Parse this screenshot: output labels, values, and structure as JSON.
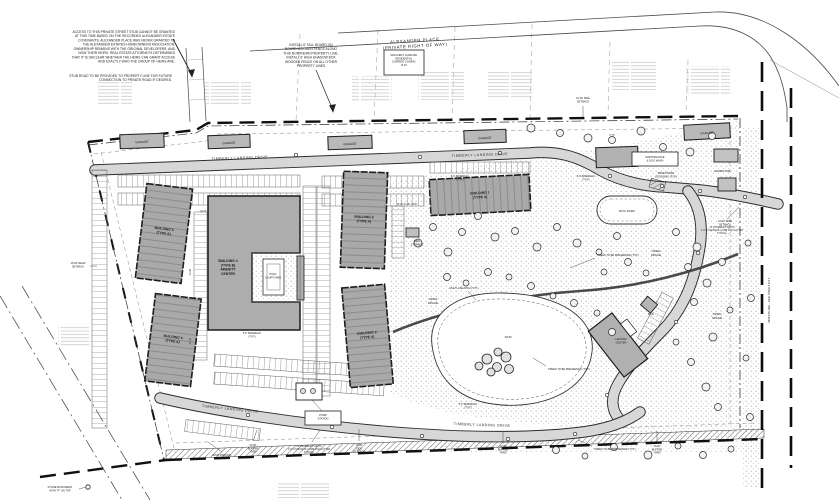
{
  "d": {
    "streets": {
      "alex": [
        "ALEXANDER PLACE",
        "(PRIVATE RIGHT OF WAY)"
      ],
      "timberly": "TIMBERLY LANDING DRIVE"
    },
    "notes": {
      "access": [
        "ACCESS TO THIS PRIVATE STREET STUB CANNOT BE GRANTED",
        "AT THIS TIME BASED ON THE RECORDED ALEXANDER ESTATE",
        "COVENANTS. ALEXANDER PLACE WAS NEVER GRANTED TO",
        "THE ALEXANDER ESTATES HOMEOWNERS ASSOCIATION.",
        "OWNERSHIP REMAINS WITH THE ORIGINAL DEVELOPERS, AND",
        "NOW THEIR HEIRS. REAL ESTATE ATTORNEYS DETERMINED",
        "THAT IT IS UNCLEAR WHETHER THE HEIRS CAN GRANT ACCESS",
        "AND EXACTLY WHO THE GROUP OF HEIRS ARE."
      ],
      "stub": [
        "STUB ROAD TO BE PROVIDED TO PROPERTY LINE FOR FUTURE",
        "CONNECTION TO PRIVATE ROAD IF DESIRED."
      ],
      "fence": [
        "INSTALL 6' TALL BOARD ON",
        "BOARD WOODEN FENCE ALONG",
        "THIS NORTHERN PROPERTY LINE.",
        "INSTALL 6' HIGH SHADOW BOX",
        "WOODEN FENCE ON ALL OTHER",
        "PROPERTY LINES"
      ]
    },
    "zoning": [
      "ADJACENT LANDUSE:",
      "RESIDENTIAL",
      "CURRENT ZONING:",
      "R-15"
    ],
    "bld": {
      "b1": [
        "BUILDING 1",
        "(TYPE A)"
      ],
      "b2": [
        "BUILDING 2",
        "(TYPE A)"
      ],
      "b3": [
        "BUILDING 3",
        "(TYPE A)"
      ],
      "b4": [
        "BUILDING 4",
        "(TYPE B)",
        "AMENITY",
        "CENTER"
      ],
      "b5": [
        "BUILDING 5",
        "(TYPE A)"
      ],
      "b6": [
        "BUILDING 6",
        "(TYPE A)"
      ],
      "garage": "GARAGE",
      "leasing": [
        "LEASING",
        "CENTER"
      ],
      "maintenance": [
        "MAINTENANCE",
        "& DOG WASH"
      ],
      "compactor": "COMPACTOR",
      "mail": "MAIL",
      "pump": [
        "PUMP",
        "STATION"
      ],
      "pool": [
        "POOL",
        "COURTYARD"
      ],
      "bike": [
        "BIKE",
        "STORAGE"
      ]
    },
    "site": {
      "dog_park": "DOG PARK",
      "open_space": [
        "OPEN",
        "SPACE"
      ],
      "scm": "SCM",
      "path": "MULTI-USE PATH (TYP.)",
      "trees": "TREES TO BE PRESERVED (TYP.)",
      "pedx": [
        "PEDESTRIAN",
        "CROSSING (TYP.)"
      ],
      "sidewalk": [
        "5.0' SIDEWALK",
        "(TYP.)"
      ],
      "boat": [
        "BOAT PARKING",
        "(TYP.)"
      ],
      "monument": [
        "STONE MONUMENT",
        "WITH \"P\" ON TOP"
      ]
    },
    "set": {
      "rear": [
        "15.00' REAR",
        "SETBACK"
      ],
      "side3": [
        "10.00'",
        "SIDE",
        "SETBACK"
      ],
      "side2": [
        "10.00' SIDE",
        "SETBACK"
      ],
      "buf20": [
        "20.00'",
        "BUFFER",
        "YARD"
      ],
      "buf10": [
        "10.00'",
        "BUFFER",
        "YARD"
      ],
      "pave": [
        "21' PAVEMENT WIDTH",
        "2'-6\" CONCRETE CURB AND GUTTER",
        "TYPICAL"
      ]
    },
    "matchline": "MATCHLINE - SEE SHEET C3.1",
    "dims": {
      "d1": "34.33'",
      "d2": "44.00'",
      "d3": "41.33'",
      "d4": "15.00'  24.00'  18.00'",
      "d5": "77.67'"
    }
  }
}
